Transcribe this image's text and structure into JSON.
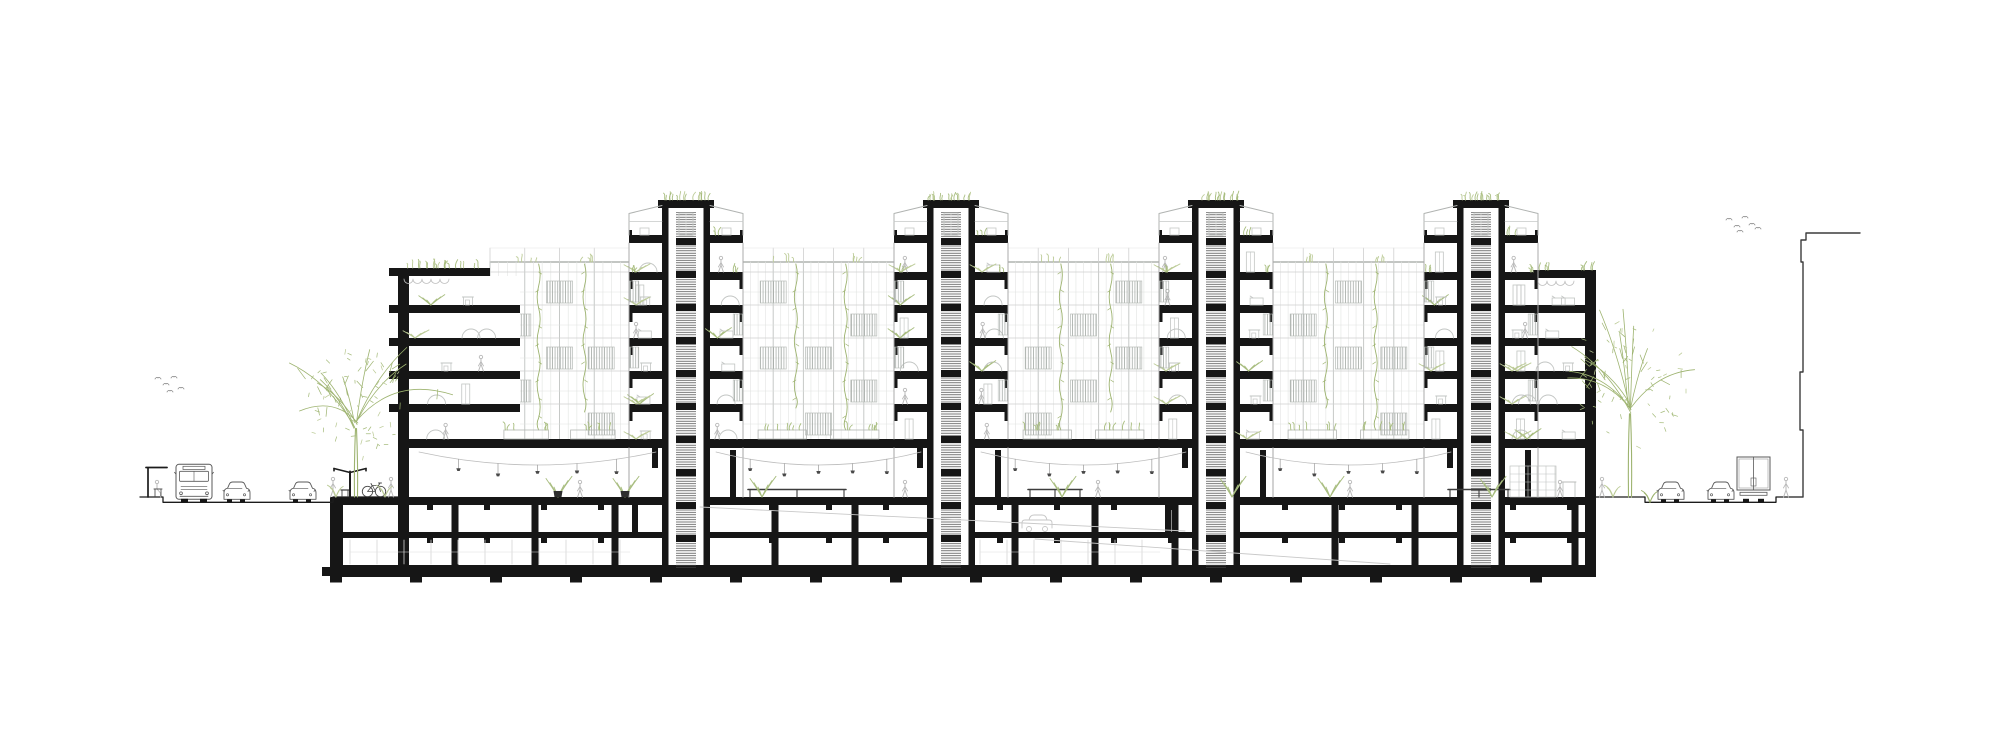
{
  "canvas": {
    "width": 2000,
    "height": 743,
    "background": "#ffffff"
  },
  "palette": {
    "section_black": "#161616",
    "outline_dark": "#1c1c1c",
    "elevation_light": "#c6c9c7",
    "elevation_lighter": "#e0e2e0",
    "elevation_mid": "#a9ada9",
    "furniture_gray": "#c2c5c3",
    "object_gray": "#585858",
    "pedestrian_gray": "#b9b9b9",
    "green": "#a8bd7f",
    "green_soft": "#bccb97",
    "green_vine": "#9db36f",
    "panel_stroke": "#b7bcb8",
    "neighbor": "#3c3c3c",
    "pot_dark": "#2e2e2e"
  },
  "levels": {
    "ground_y": 497,
    "road_y": 502.3,
    "slab_tops": [
      272,
      305,
      338,
      371,
      404
    ],
    "slab_h": 8,
    "podium_top": 439,
    "podium_h": 9,
    "terrace_top": 235,
    "core_roof_top": 200,
    "low_roof_left_top": 268,
    "low_roof_right_top": 270,
    "ground_slab_top": 497,
    "ground_slab_bot": 505,
    "b1_bot": 532,
    "b1_slab_bot": 538,
    "b2_bot": 565,
    "found_top": 565,
    "found_bot": 577,
    "feet_bot": 583,
    "facade_top": 262,
    "hall_top": 448
  },
  "building": {
    "left": 398,
    "right": 1596,
    "wall_w": 11,
    "basement_left": 330,
    "basement_wall_w": 13,
    "tower_centers": [
      686,
      951,
      1216,
      1481
    ],
    "core": {
      "half_w": 24,
      "wall_w": 6.5,
      "stair_half": 10,
      "bay_half": 57
    },
    "facade_spans": [
      [
        490,
        629
      ],
      [
        743,
        894
      ],
      [
        1008,
        1159
      ],
      [
        1273,
        1424
      ]
    ],
    "low_rise_left": {
      "x1": 398,
      "x2": 520,
      "roof_x1": 398,
      "roof_x2": 490
    },
    "low_rise_right": {
      "x1": 1506,
      "x2": 1596,
      "roof_x1": 1533,
      "roof_x2": 1596
    }
  },
  "hall": {
    "tables": [
      {
        "x1": 748,
        "x2": 846
      },
      {
        "x1": 1028,
        "x2": 1082
      },
      {
        "x1": 1448,
        "x2": 1510
      }
    ],
    "plants": [
      558,
      625,
      762,
      1062,
      1232,
      1330,
      1492
    ],
    "pots": [
      558,
      625
    ],
    "people": [
      580,
      905,
      1098,
      1350,
      1560
    ],
    "bookshelf": {
      "x1": 1510,
      "x2": 1556,
      "top": 466
    }
  },
  "basement": {
    "column_start": 455,
    "column_step": 80,
    "beam_step": 57,
    "partitions": [
      635,
      1168
    ],
    "storage_ranges": [
      [
        350,
        630
      ],
      [
        980,
        1160
      ]
    ],
    "ramps": [
      [
        700,
        507,
        1185,
        531
      ],
      [
        1035,
        539,
        1390,
        564
      ]
    ],
    "car_x": 1022
  },
  "street_left": {
    "line_x1": 140,
    "curb_x1": 163,
    "curb_x2": 333,
    "objects": [
      {
        "type": "bus_shelter",
        "x": 146
      },
      {
        "type": "bus",
        "x": 176
      },
      {
        "type": "car",
        "x": 222
      },
      {
        "type": "car",
        "x": 288
      },
      {
        "type": "pedestrian",
        "x": 333
      },
      {
        "type": "bench",
        "x": 341
      },
      {
        "type": "street_lamp",
        "x": 350
      },
      {
        "type": "bicycle",
        "x": 362
      },
      {
        "type": "pedestrian",
        "x": 391
      },
      {
        "type": "shrub",
        "x": 336
      },
      {
        "type": "shrub",
        "x": 385
      }
    ]
  },
  "street_right": {
    "curb_x1": 1645,
    "curb_x2": 1776,
    "line_x2": 1803,
    "objects": [
      {
        "type": "pedestrian",
        "x": 1602
      },
      {
        "type": "shrub",
        "x": 1613
      },
      {
        "type": "shrub_small",
        "x": 1650
      },
      {
        "type": "car",
        "x": 1656
      },
      {
        "type": "car",
        "x": 1706
      },
      {
        "type": "truck",
        "x": 1737
      },
      {
        "type": "pedestrian",
        "x": 1786
      }
    ]
  },
  "trees": [
    {
      "x": 356,
      "canopy_top": 345,
      "spread": 50,
      "seed": 7
    },
    {
      "x": 1630,
      "canopy_top": 312,
      "spread": 58,
      "seed": 11
    }
  ],
  "birds": {
    "left": [
      [
        158,
        378
      ],
      [
        166,
        384
      ],
      [
        174,
        377
      ],
      [
        181,
        388
      ],
      [
        170,
        391
      ]
    ],
    "right": [
      [
        1729,
        219
      ],
      [
        1737,
        226
      ],
      [
        1745,
        217
      ],
      [
        1752,
        224
      ],
      [
        1740,
        231
      ],
      [
        1758,
        228
      ]
    ]
  },
  "neighbor_building": {
    "points": [
      [
        1803,
        497
      ],
      [
        1803,
        430
      ],
      [
        1800,
        430
      ],
      [
        1800,
        372
      ],
      [
        1803,
        372
      ],
      [
        1803,
        262
      ],
      [
        1801,
        262
      ],
      [
        1801,
        240
      ],
      [
        1806,
        240
      ],
      [
        1806,
        233
      ],
      [
        1860,
        233
      ]
    ]
  },
  "decor": {
    "seed": 42,
    "room_motifs": [
      "sofa",
      "desk",
      "arch",
      "wardrobe",
      "plant",
      "person"
    ]
  }
}
